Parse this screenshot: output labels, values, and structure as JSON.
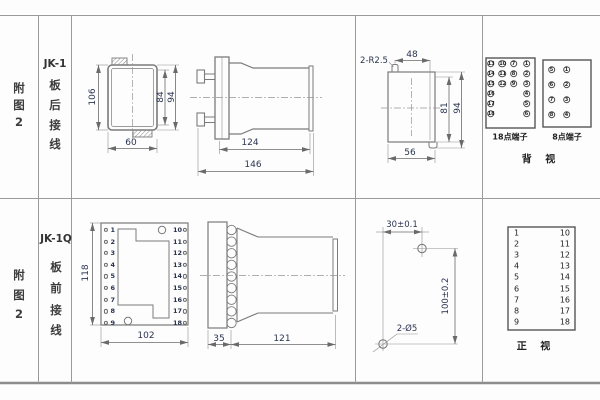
{
  "colors": {
    "line": "#7b7b7b",
    "grid": "#9a9a9a",
    "dim_text": "#2b3550",
    "dark_border": "#555555"
  },
  "left_panel": {
    "top": {
      "fig": [
        "附",
        "图",
        "2"
      ],
      "model": "JK-1",
      "wiring": [
        "板",
        "后",
        "接",
        "线"
      ]
    },
    "bottom": {
      "fig": [
        "附",
        "图",
        "2"
      ],
      "model": "JK-1Q",
      "wiring": [
        "板",
        "前",
        "接",
        "线"
      ]
    }
  },
  "jk1": {
    "rear_view": {
      "d106": "106",
      "d84": "84",
      "d94": "94",
      "d60": "60"
    },
    "side_view": {
      "d124": "124",
      "d146": "146"
    },
    "panel_cutout": {
      "radius": "2-R2.5",
      "d48": "48",
      "d81": "81",
      "d94": "94",
      "d56": "56"
    },
    "terminal18": {
      "label": "18点端子",
      "grid": [
        [
          "13",
          "10",
          "7",
          "1"
        ],
        [
          "14",
          "11",
          "8",
          "2"
        ],
        [
          "15",
          "12",
          "9",
          "3"
        ],
        [
          "16",
          "",
          "",
          "4"
        ],
        [
          "17",
          "",
          "",
          "5"
        ],
        [
          "18",
          "",
          "",
          "6"
        ]
      ]
    },
    "terminal8": {
      "label": "8点端子",
      "grid": [
        [
          "5",
          "1"
        ],
        [
          "6",
          "2"
        ],
        [
          "7",
          "3"
        ],
        [
          "8",
          "4"
        ]
      ]
    },
    "view_label": "背 视"
  },
  "jk1q": {
    "front_view": {
      "d118": "118",
      "d102": "102",
      "left_terminals": [
        "1",
        "2",
        "3",
        "4",
        "5",
        "6",
        "7",
        "8",
        "9"
      ],
      "right_terminals": [
        "10",
        "11",
        "12",
        "13",
        "14",
        "15",
        "16",
        "17",
        "18"
      ]
    },
    "side_view": {
      "d35": "35",
      "d121": "121"
    },
    "drill_plan": {
      "d30": "30±0.1",
      "d100": "100±0.2",
      "holes": "2-Ø5"
    },
    "terminal_table": {
      "left": [
        "1",
        "2",
        "3",
        "4",
        "5",
        "6",
        "7",
        "8",
        "9"
      ],
      "right": [
        "10",
        "11",
        "12",
        "13",
        "14",
        "15",
        "16",
        "17",
        "18"
      ]
    },
    "view_label": "正 视"
  }
}
